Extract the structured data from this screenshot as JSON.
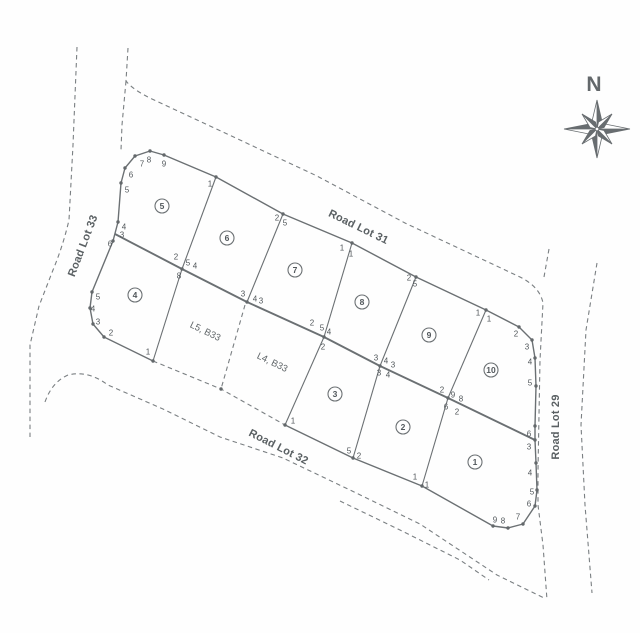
{
  "map": {
    "north_label": "N",
    "colors": {
      "line": "#6b7073",
      "dash": "#7a7f82",
      "text": "#51575a"
    },
    "roads": [
      {
        "label": "Road Lot 31",
        "x": 357,
        "y": 230,
        "rotate": 26
      },
      {
        "label": "Road Lot 32",
        "x": 277,
        "y": 450,
        "rotate": 27
      },
      {
        "label": "Road Lot 33",
        "x": 86,
        "y": 247,
        "rotate": -69
      },
      {
        "label": "Road Lot 29",
        "x": 559,
        "y": 427,
        "rotate": -90
      }
    ],
    "lots": [
      {
        "n": "5",
        "x": 162,
        "y": 206
      },
      {
        "n": "6",
        "x": 227,
        "y": 238
      },
      {
        "n": "7",
        "x": 295,
        "y": 270
      },
      {
        "n": "8",
        "x": 362,
        "y": 302
      },
      {
        "n": "9",
        "x": 429,
        "y": 335
      },
      {
        "n": "10",
        "x": 491,
        "y": 370
      },
      {
        "n": "4",
        "x": 135,
        "y": 295
      },
      {
        "n": "3",
        "x": 335,
        "y": 394
      },
      {
        "n": "2",
        "x": 403,
        "y": 427
      },
      {
        "n": "1",
        "x": 475,
        "y": 462
      }
    ],
    "adjacent_lots": [
      {
        "label": "L5, B33",
        "x": 204,
        "y": 334,
        "rotate": 26
      },
      {
        "label": "L4, B33",
        "x": 271,
        "y": 365,
        "rotate": 26
      }
    ],
    "vertex_labels": [
      {
        "t": "7",
        "x": 142,
        "y": 164
      },
      {
        "t": "8",
        "x": 149,
        "y": 160
      },
      {
        "t": "9",
        "x": 164,
        "y": 164
      },
      {
        "t": "6",
        "x": 131,
        "y": 175
      },
      {
        "t": "5",
        "x": 127,
        "y": 190
      },
      {
        "t": "4",
        "x": 124,
        "y": 227
      },
      {
        "t": "3",
        "x": 122,
        "y": 235
      },
      {
        "t": "6",
        "x": 110,
        "y": 244
      },
      {
        "t": "5",
        "x": 98,
        "y": 297
      },
      {
        "t": "4",
        "x": 93,
        "y": 309
      },
      {
        "t": "3",
        "x": 98,
        "y": 322
      },
      {
        "t": "2",
        "x": 111,
        "y": 333
      },
      {
        "t": "1",
        "x": 148,
        "y": 352
      },
      {
        "t": "1",
        "x": 210,
        "y": 184
      },
      {
        "t": "2",
        "x": 277,
        "y": 218
      },
      {
        "t": "5",
        "x": 285,
        "y": 223
      },
      {
        "t": "1",
        "x": 342,
        "y": 248
      },
      {
        "t": "1",
        "x": 351,
        "y": 254
      },
      {
        "t": "2",
        "x": 409,
        "y": 278
      },
      {
        "t": "5",
        "x": 415,
        "y": 284
      },
      {
        "t": "1",
        "x": 478,
        "y": 313
      },
      {
        "t": "1",
        "x": 489,
        "y": 319
      },
      {
        "t": "2",
        "x": 516,
        "y": 334
      },
      {
        "t": "3",
        "x": 527,
        "y": 347
      },
      {
        "t": "4",
        "x": 530,
        "y": 362
      },
      {
        "t": "5",
        "x": 530,
        "y": 383
      },
      {
        "t": "6",
        "x": 529,
        "y": 434
      },
      {
        "t": "3",
        "x": 529,
        "y": 447
      },
      {
        "t": "4",
        "x": 530,
        "y": 473
      },
      {
        "t": "5",
        "x": 532,
        "y": 492
      },
      {
        "t": "6",
        "x": 529,
        "y": 504
      },
      {
        "t": "7",
        "x": 518,
        "y": 517
      },
      {
        "t": "8",
        "x": 503,
        "y": 521
      },
      {
        "t": "9",
        "x": 495,
        "y": 520
      },
      {
        "t": "2",
        "x": 176,
        "y": 257
      },
      {
        "t": "5",
        "x": 188,
        "y": 263
      },
      {
        "t": "4",
        "x": 195,
        "y": 266
      },
      {
        "t": "8",
        "x": 179,
        "y": 276
      },
      {
        "t": "3",
        "x": 243,
        "y": 294
      },
      {
        "t": "4",
        "x": 255,
        "y": 299
      },
      {
        "t": "3",
        "x": 261,
        "y": 301
      },
      {
        "t": "2",
        "x": 312,
        "y": 323
      },
      {
        "t": "5",
        "x": 322,
        "y": 328
      },
      {
        "t": "4",
        "x": 329,
        "y": 332
      },
      {
        "t": "2",
        "x": 323,
        "y": 347
      },
      {
        "t": "3",
        "x": 376,
        "y": 358
      },
      {
        "t": "4",
        "x": 386,
        "y": 361
      },
      {
        "t": "3",
        "x": 393,
        "y": 365
      },
      {
        "t": "3",
        "x": 379,
        "y": 373
      },
      {
        "t": "4",
        "x": 388,
        "y": 375
      },
      {
        "t": "2",
        "x": 442,
        "y": 390
      },
      {
        "t": "9",
        "x": 453,
        "y": 395
      },
      {
        "t": "8",
        "x": 461,
        "y": 399
      },
      {
        "t": "6",
        "x": 446,
        "y": 407
      },
      {
        "t": "2",
        "x": 457,
        "y": 412
      },
      {
        "t": "1",
        "x": 293,
        "y": 421
      },
      {
        "t": "5",
        "x": 349,
        "y": 451
      },
      {
        "t": "2",
        "x": 359,
        "y": 456
      },
      {
        "t": "1",
        "x": 415,
        "y": 477
      },
      {
        "t": "1",
        "x": 427,
        "y": 485
      }
    ]
  }
}
